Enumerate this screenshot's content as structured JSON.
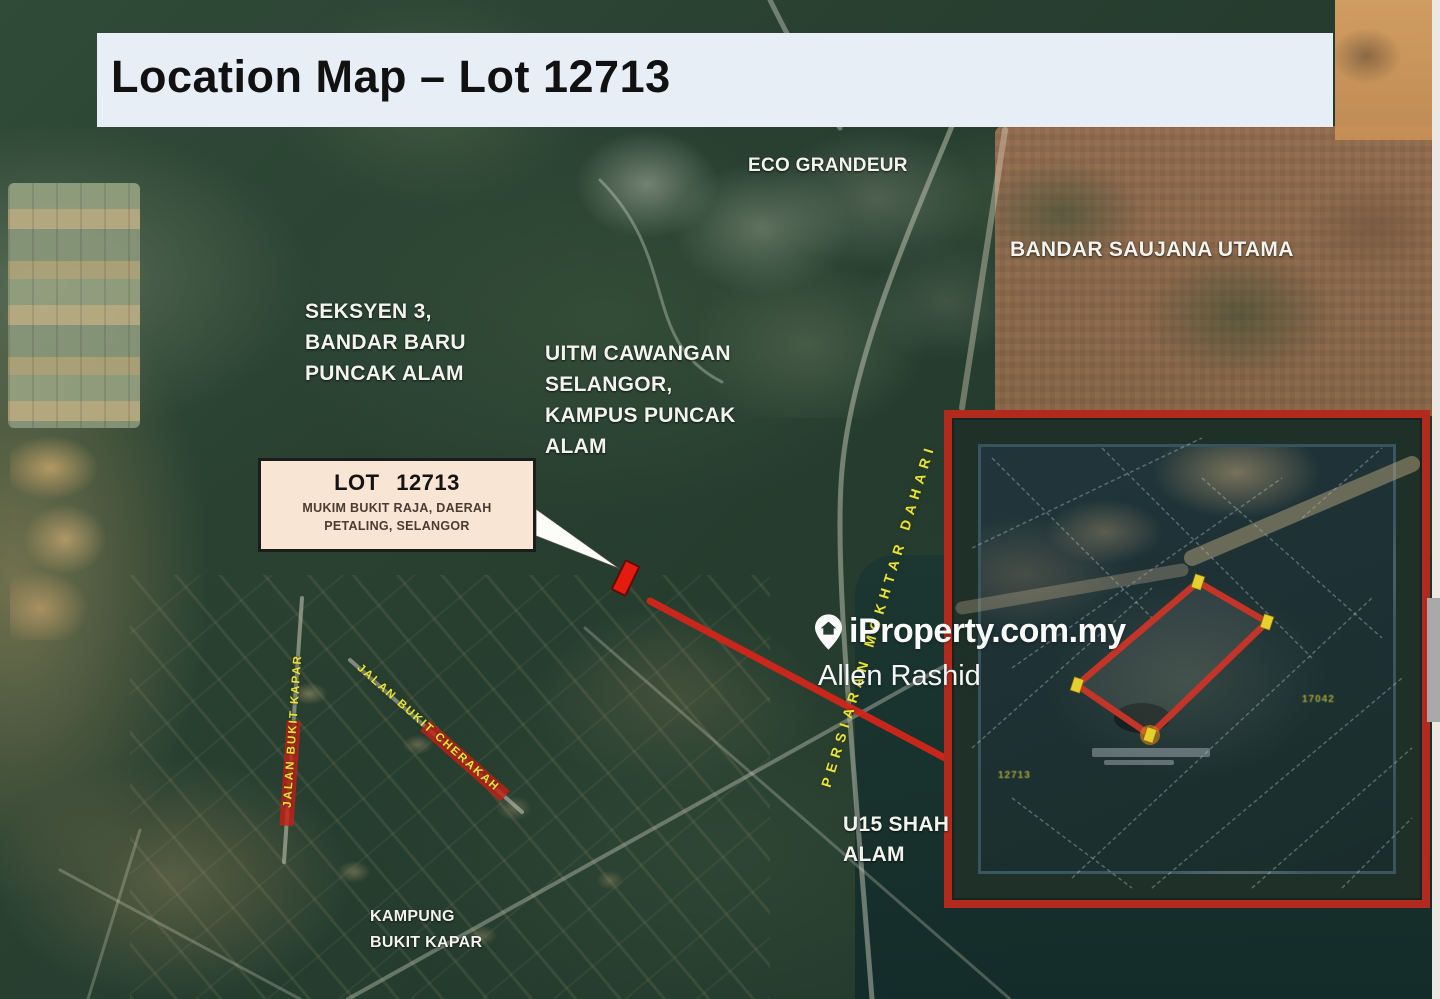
{
  "title": "Location Map – Lot 12713",
  "map_labels": {
    "eco_grandeur": "ECO GRANDEUR",
    "bandar_saujana_utama": "BANDAR SAUJANA UTAMA",
    "seksyen3": [
      "SEKSYEN 3,",
      "BANDAR BARU",
      "PUNCAK ALAM"
    ],
    "uitm": [
      "UITM CAWANGAN",
      "SELANGOR,",
      "KAMPUS PUNCAK",
      "ALAM"
    ],
    "u15": [
      "U15 SHAH",
      "ALAM"
    ],
    "kampung": [
      "KAMPUNG",
      "BUKIT KAPAR"
    ]
  },
  "road_labels": {
    "persiaran": "PERSIARAN MOKHTAR DAHARI",
    "jalan_vertical": "JALAN BUKIT KAPAR",
    "jalan_diagonal": "JALAN BUKIT CHERAKAH"
  },
  "callout": {
    "title": "LOT 12713",
    "line1": "MUKIM BUKIT RAJA, DAERAH",
    "line2": "PETALING, SELANGOR"
  },
  "watermark": {
    "brand": "iProperty.com.my",
    "agent": "Allen Rashid",
    "pin_icon": "location-pin"
  },
  "inset": {
    "parcel_labels": [
      "12713",
      "17042"
    ]
  },
  "colors": {
    "title_bar_bg": "#E7EEF6",
    "title_text": "#111111",
    "callout_bg": "#F8E5D4",
    "inset_border_red": "#B22A1E",
    "polygon_red": "#C23528",
    "marker_red": "#E41C10",
    "connector_red": "#D2261A",
    "road_label_yellow": "#E9E43B",
    "vertex_marker_yellow": "#E6D02F",
    "map_label_white": "#F4F4EF"
  }
}
